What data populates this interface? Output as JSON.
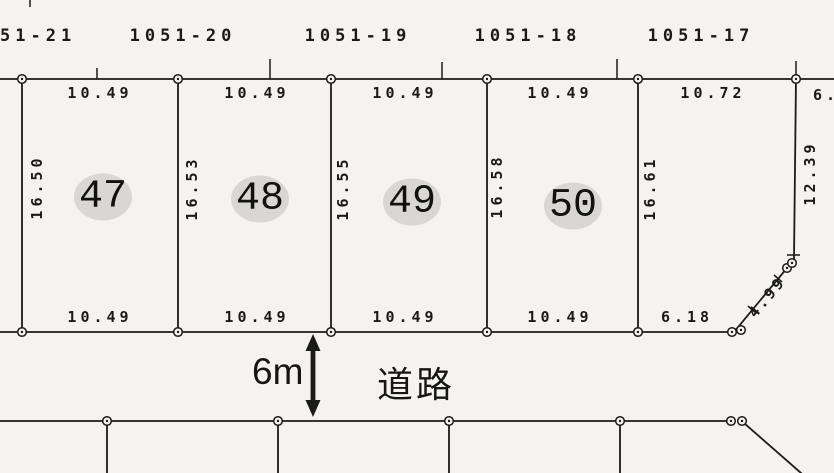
{
  "upper_parcels": {
    "labels": [
      "51-21",
      "1051-20",
      "1051-19",
      "1051-18",
      "1051-17"
    ]
  },
  "lots": [
    {
      "number": "47",
      "top_dim": "10.49",
      "bottom_dim": "10.49",
      "side_dim": "16.50"
    },
    {
      "number": "48",
      "top_dim": "10.49",
      "bottom_dim": "10.49",
      "side_dim": "16.53"
    },
    {
      "number": "49",
      "top_dim": "10.49",
      "bottom_dim": "10.49",
      "side_dim": "16.55"
    },
    {
      "number": "50",
      "top_dim": "10.49",
      "bottom_dim": "10.49",
      "side_dim": "16.58"
    }
  ],
  "corner_lot": {
    "side_dim": "16.61",
    "top_dim": "10.72",
    "top_dim_partial": "6.",
    "right_dim": "12.39",
    "bottom_dim": "6.18",
    "diagonal_dim": "4.99"
  },
  "road": {
    "width": "6m",
    "label": "道路"
  }
}
